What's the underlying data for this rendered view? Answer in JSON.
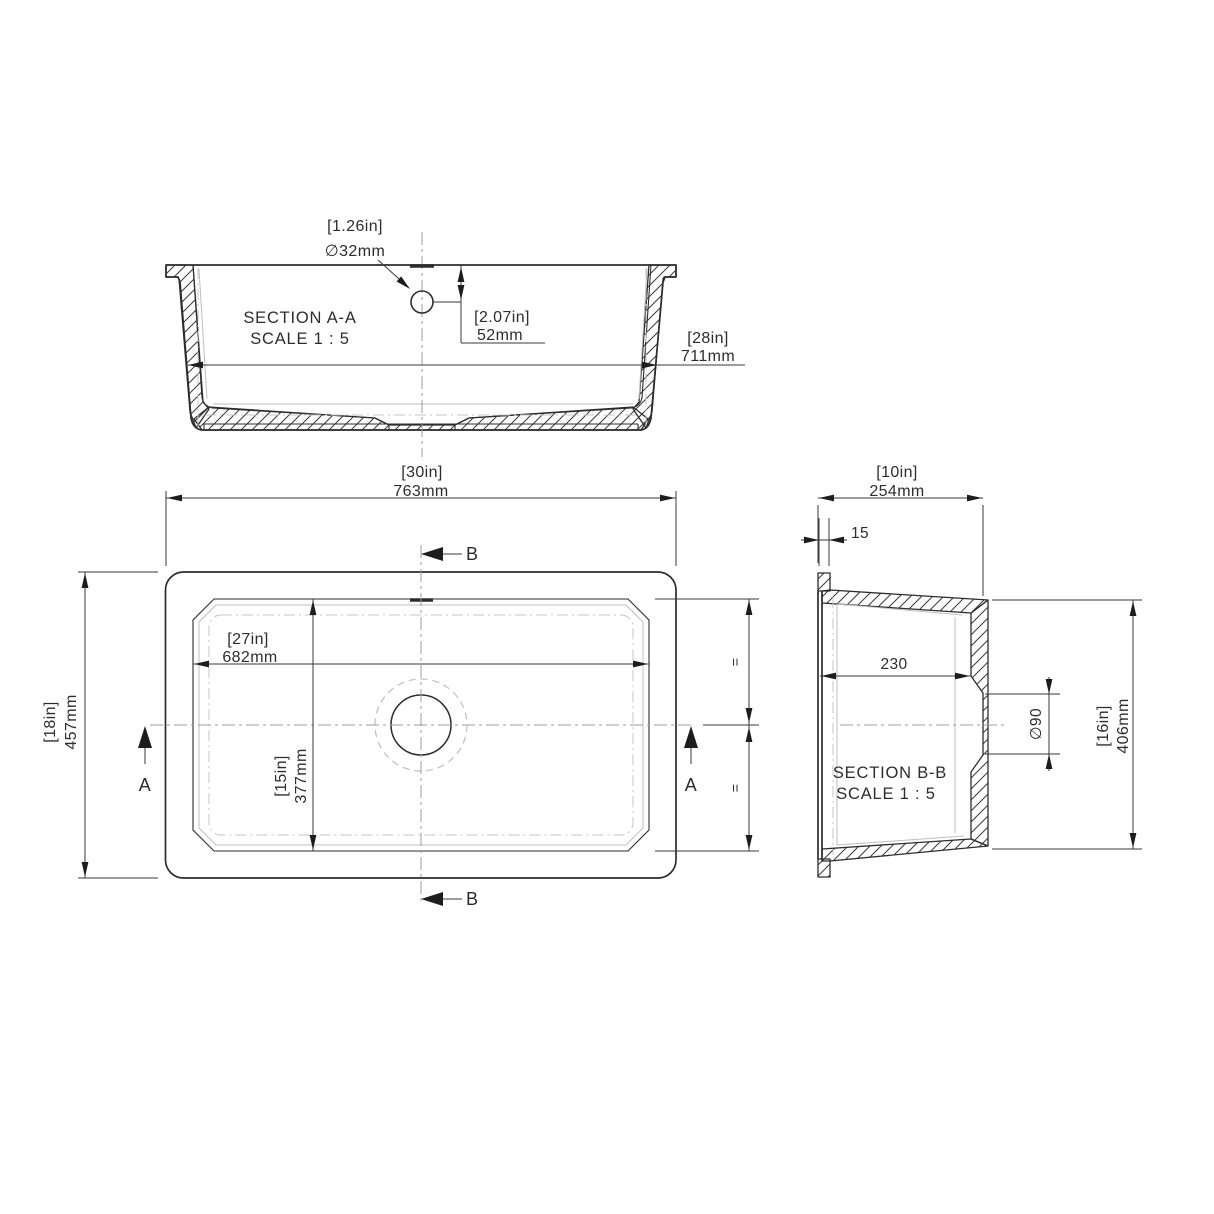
{
  "drawing": {
    "section_aa": {
      "title": "SECTION A-A",
      "scale": "SCALE 1 : 5",
      "hole_dia_in": "[1.26in]",
      "hole_dia_mm": "∅32mm",
      "hole_offset_in": "[2.07in]",
      "hole_offset_mm": "52mm",
      "rim_width_in": "[28in]",
      "rim_width_mm": "711mm"
    },
    "plan": {
      "overall_width_in": "[30in]",
      "overall_width_mm": "763mm",
      "overall_depth_in": "[18in]",
      "overall_depth_mm": "457mm",
      "basin_width_in": "[27in]",
      "basin_width_mm": "682mm",
      "basin_depth_in": "[15in]",
      "basin_depth_mm": "377mm",
      "equal_top": "=",
      "equal_bottom": "=",
      "cut_a": "A",
      "cut_b": "B"
    },
    "section_bb": {
      "title": "SECTION B-B",
      "scale": "SCALE 1 : 5",
      "overall_width_in": "[10in]",
      "overall_width_mm": "254mm",
      "rim_thickness": "15",
      "basin_inner": "230",
      "drain_dia": "∅90",
      "overall_height_in": "[16in]",
      "overall_height_mm": "406mm"
    },
    "colors": {
      "line": "#2d2d2d",
      "hidden": "#bfbfbf",
      "centerline": "#9c9c9c"
    }
  }
}
